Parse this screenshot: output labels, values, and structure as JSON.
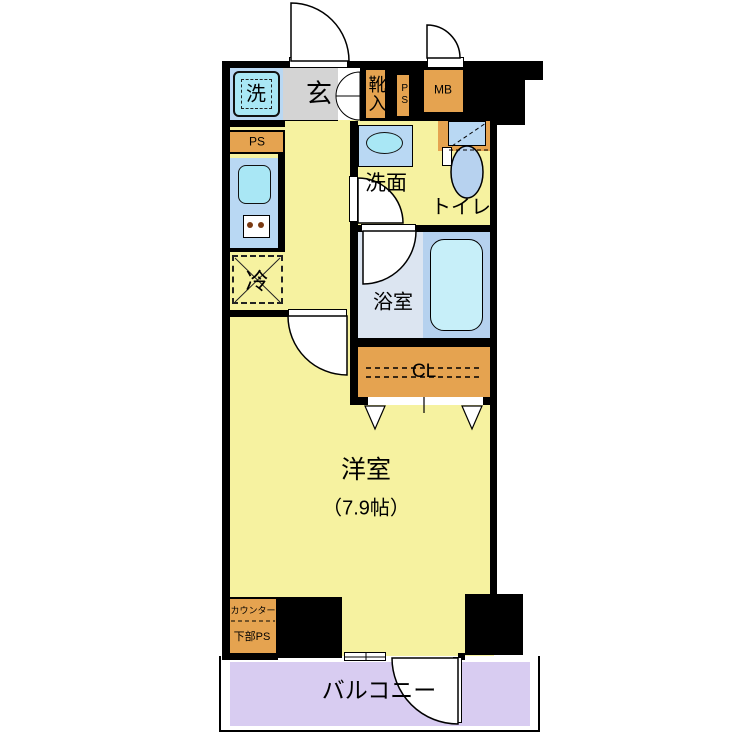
{
  "floorplan": {
    "type": "apartment-floor-plan",
    "rooms": {
      "washing_machine": {
        "label": "洗"
      },
      "entrance": {
        "label": "玄"
      },
      "shoe_cabinet": {
        "label": "靴入"
      },
      "pipe_shaft_entrance": {
        "label": "PS"
      },
      "meter_box": {
        "label": "MB"
      },
      "pipe_shaft_kitchen": {
        "label": "PS"
      },
      "washroom": {
        "label": "洗面"
      },
      "toilet": {
        "label": "トイレ"
      },
      "refrigerator_space": {
        "label": "冷"
      },
      "bathroom": {
        "label": "浴室"
      },
      "closet": {
        "label": "CL"
      },
      "western_room": {
        "label": "洋室",
        "size": "（7.9帖）"
      },
      "counter_ps": {
        "label": "カウンター",
        "sublabel": "下部PS"
      },
      "balcony": {
        "label": "バルコニー"
      }
    },
    "colors": {
      "wall": "#000000",
      "room_yellow": "#F6F2A0",
      "entrance_gray": "#D4D4D4",
      "cabinet_orange": "#E5A350",
      "panel_blue": "#B9D8F3",
      "fixture_cyan": "#A9E7F5",
      "bath_floor": "#DCE5F1",
      "bath_tub_zone": "#B5D1EE",
      "bathtub": "#C7EFF9",
      "toilet_bowl": "#B7D2EF",
      "balcony_purple": "#D8CCF1"
    }
  }
}
